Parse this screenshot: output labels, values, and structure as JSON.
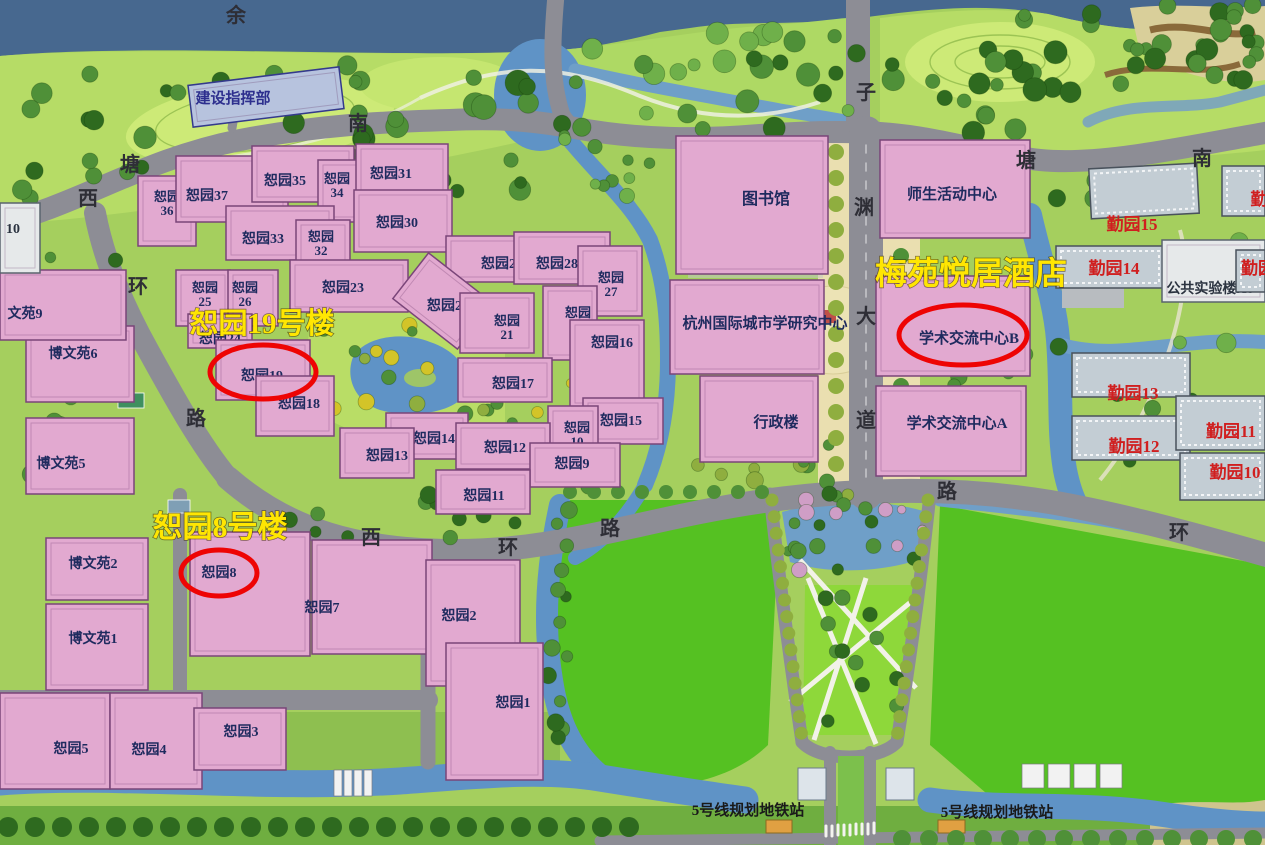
{
  "map_title": "校园总平面图",
  "colors": {
    "water_top": "#47688f",
    "water": "#5f93c6",
    "field_green": "#55c122",
    "ground": "#a5cf5e",
    "meadow": "#b6dc66",
    "road": "#8d8d95",
    "building_pink": "#e2a9d0",
    "building_gray": "#c3cdd4",
    "label_navy": "#1e2a5e",
    "label_red": "#d01f1f",
    "annotation_yellow": "#ffe602",
    "highlight_red": "#ee0404",
    "plaza_tan": "#eadfb0",
    "metro_orange": "#e0a042"
  },
  "annotations": [
    {
      "text": "恕园19号楼",
      "x": 262,
      "y": 333,
      "size": 29
    },
    {
      "text": "恕园8号楼",
      "x": 220,
      "y": 537,
      "size": 30
    },
    {
      "text": "梅苑悦居酒店",
      "x": 971,
      "y": 284,
      "size": 32
    }
  ],
  "highlights": [
    {
      "cx": 263,
      "cy": 372,
      "rx": 53,
      "ry": 27
    },
    {
      "cx": 219,
      "cy": 573,
      "rx": 38,
      "ry": 23
    },
    {
      "cx": 963,
      "cy": 335,
      "rx": 64,
      "ry": 30
    }
  ],
  "buildings": [
    {
      "label": "恕园36",
      "two": true,
      "kind": "p",
      "x": 138,
      "y": 176,
      "w": 58,
      "h": 70,
      "lx": 167,
      "ly": 201
    },
    {
      "label": "恕园37",
      "kind": "p",
      "x": 176,
      "y": 156,
      "w": 112,
      "h": 66,
      "lx": 207,
      "ly": 200
    },
    {
      "label": "恕园35",
      "kind": "p",
      "x": 252,
      "y": 146,
      "w": 102,
      "h": 56,
      "lx": 285,
      "ly": 185
    },
    {
      "label": "恕园34",
      "two": true,
      "kind": "p",
      "x": 318,
      "y": 160,
      "w": 54,
      "h": 62,
      "lx": 337,
      "ly": 183
    },
    {
      "label": "恕园31",
      "kind": "p",
      "x": 356,
      "y": 144,
      "w": 92,
      "h": 52,
      "lx": 391,
      "ly": 178
    },
    {
      "label": "恕园33",
      "kind": "p",
      "x": 226,
      "y": 206,
      "w": 108,
      "h": 54,
      "lx": 263,
      "ly": 243
    },
    {
      "label": "恕园32",
      "two": true,
      "kind": "p",
      "x": 296,
      "y": 220,
      "w": 54,
      "h": 58,
      "lx": 321,
      "ly": 241
    },
    {
      "label": "恕园30",
      "kind": "p",
      "x": 354,
      "y": 190,
      "w": 98,
      "h": 62,
      "lx": 397,
      "ly": 227
    },
    {
      "label": "恕园29",
      "kind": "p",
      "x": 446,
      "y": 236,
      "w": 92,
      "h": 46,
      "lx": 502,
      "ly": 268
    },
    {
      "label": "恕园28",
      "kind": "p",
      "x": 514,
      "y": 232,
      "w": 96,
      "h": 52,
      "lx": 557,
      "ly": 268
    },
    {
      "label": "恕园27",
      "two": true,
      "kind": "p",
      "x": 578,
      "y": 246,
      "w": 64,
      "h": 70,
      "lx": 611,
      "ly": 282
    },
    {
      "label": "恕园25",
      "two": true,
      "kind": "p",
      "x": 176,
      "y": 270,
      "w": 54,
      "h": 56,
      "lx": 205,
      "ly": 292
    },
    {
      "label": "恕园26",
      "two": true,
      "kind": "p",
      "x": 228,
      "y": 270,
      "w": 50,
      "h": 56,
      "lx": 245,
      "ly": 292
    },
    {
      "label": "恕园24",
      "kind": "p",
      "x": 188,
      "y": 314,
      "w": 64,
      "h": 34,
      "lx": 220,
      "ly": 343
    },
    {
      "label": "恕园23",
      "kind": "p",
      "x": 290,
      "y": 260,
      "w": 118,
      "h": 52,
      "lx": 343,
      "ly": 292
    },
    {
      "label": "恕园22",
      "kind": "p",
      "x": 402,
      "y": 272,
      "w": 82,
      "h": 58,
      "rot": 38,
      "lx": 448,
      "ly": 310
    },
    {
      "label": "恕园21",
      "two": true,
      "kind": "p",
      "x": 460,
      "y": 293,
      "w": 74,
      "h": 60,
      "lx": 507,
      "ly": 325
    },
    {
      "label": "恕园20",
      "two": true,
      "kind": "p",
      "x": 543,
      "y": 286,
      "w": 54,
      "h": 74,
      "lx": 578,
      "ly": 317
    },
    {
      "label": "恕园16",
      "kind": "p",
      "x": 570,
      "y": 320,
      "w": 74,
      "h": 88,
      "lx": 612,
      "ly": 347
    },
    {
      "label": "恕园19",
      "kind": "p",
      "x": 216,
      "y": 340,
      "w": 94,
      "h": 60,
      "lx": 262,
      "ly": 380
    },
    {
      "label": "恕园18",
      "kind": "p",
      "x": 256,
      "y": 376,
      "w": 78,
      "h": 60,
      "lx": 299,
      "ly": 408
    },
    {
      "label": "恕园17",
      "kind": "p",
      "x": 458,
      "y": 358,
      "w": 94,
      "h": 44,
      "lx": 513,
      "ly": 388
    },
    {
      "label": "恕园14",
      "kind": "p",
      "x": 386,
      "y": 413,
      "w": 82,
      "h": 46,
      "lx": 434,
      "ly": 443
    },
    {
      "label": "恕园13",
      "kind": "p",
      "x": 340,
      "y": 428,
      "w": 74,
      "h": 50,
      "lx": 387,
      "ly": 460
    },
    {
      "label": "恕园15",
      "kind": "p",
      "x": 583,
      "y": 398,
      "w": 80,
      "h": 46,
      "lx": 621,
      "ly": 425
    },
    {
      "label": "恕园10",
      "two": true,
      "kind": "p",
      "x": 548,
      "y": 406,
      "w": 50,
      "h": 64,
      "lx": 577,
      "ly": 432
    },
    {
      "label": "恕园12",
      "kind": "p",
      "x": 456,
      "y": 423,
      "w": 94,
      "h": 46,
      "lx": 505,
      "ly": 452
    },
    {
      "label": "恕园9",
      "kind": "p",
      "x": 530,
      "y": 443,
      "w": 90,
      "h": 44,
      "lx": 572,
      "ly": 468
    },
    {
      "label": "恕园11",
      "kind": "p",
      "x": 436,
      "y": 470,
      "w": 94,
      "h": 44,
      "lx": 484,
      "ly": 500
    },
    {
      "label": "图书馆",
      "kind": "p",
      "x": 676,
      "y": 136,
      "w": 152,
      "h": 138,
      "lx": 766,
      "ly": 204,
      "fs": 16
    },
    {
      "label": "师生活动中心",
      "kind": "p",
      "x": 880,
      "y": 140,
      "w": 150,
      "h": 98,
      "lx": 952,
      "ly": 199,
      "fs": 15
    },
    {
      "label": "杭州国际城市学研究中心",
      "kind": "p",
      "x": 670,
      "y": 280,
      "w": 154,
      "h": 94,
      "lx": 765,
      "ly": 328,
      "fs": 15
    },
    {
      "label": "行政楼",
      "kind": "p",
      "x": 700,
      "y": 376,
      "w": 118,
      "h": 86,
      "lx": 776,
      "ly": 427,
      "fs": 15
    },
    {
      "label": "学术交流中心B",
      "kind": "p",
      "x": 876,
      "y": 276,
      "w": 154,
      "h": 100,
      "lx": 969,
      "ly": 343,
      "fs": 15
    },
    {
      "label": "学术交流中心A",
      "kind": "p",
      "x": 876,
      "y": 386,
      "w": 150,
      "h": 90,
      "lx": 957,
      "ly": 428,
      "fs": 15
    },
    {
      "label": "恕园8",
      "kind": "p",
      "x": 190,
      "y": 532,
      "w": 120,
      "h": 124,
      "lx": 219,
      "ly": 577
    },
    {
      "label": "恕园7",
      "kind": "p",
      "x": 312,
      "y": 540,
      "w": 120,
      "h": 114,
      "lx": 322,
      "ly": 612
    },
    {
      "label": "博文苑2",
      "kind": "p",
      "x": 46,
      "y": 538,
      "w": 102,
      "h": 62,
      "lx": 93,
      "ly": 568
    },
    {
      "label": "博文苑1",
      "kind": "p",
      "x": 46,
      "y": 604,
      "w": 102,
      "h": 86,
      "lx": 93,
      "ly": 643
    },
    {
      "label": "博文苑6",
      "kind": "p",
      "x": 26,
      "y": 326,
      "w": 108,
      "h": 76,
      "lx": 73,
      "ly": 358
    },
    {
      "label": "博文苑5",
      "kind": "p",
      "x": 26,
      "y": 418,
      "w": 108,
      "h": 76,
      "lx": 61,
      "ly": 468
    },
    {
      "label": "文苑9",
      "kind": "p",
      "x": 0,
      "y": 270,
      "w": 126,
      "h": 70,
      "lx": 25,
      "ly": 318
    },
    {
      "label": "10",
      "kind": "w",
      "x": 0,
      "y": 203,
      "w": 40,
      "h": 70,
      "lx": 13,
      "ly": 233
    },
    {
      "label": "恕园5",
      "kind": "p",
      "x": 0,
      "y": 693,
      "w": 110,
      "h": 96,
      "lx": 71,
      "ly": 753
    },
    {
      "label": "恕园4",
      "kind": "p",
      "x": 110,
      "y": 693,
      "w": 92,
      "h": 96,
      "lx": 149,
      "ly": 754
    },
    {
      "label": "恕园3",
      "kind": "p",
      "x": 194,
      "y": 708,
      "w": 92,
      "h": 62,
      "lx": 241,
      "ly": 736
    },
    {
      "label": "恕园2",
      "kind": "p",
      "x": 426,
      "y": 560,
      "w": 94,
      "h": 126,
      "lx": 459,
      "ly": 620
    },
    {
      "label": "恕园1",
      "kind": "p",
      "x": 446,
      "y": 643,
      "w": 97,
      "h": 137,
      "lx": 513,
      "ly": 707
    },
    {
      "label": "勤园15",
      "kind": "g",
      "x": 1090,
      "y": 166,
      "w": 108,
      "h": 50,
      "rot": -3,
      "lx": 1132,
      "ly": 230,
      "fs": 17
    },
    {
      "label": "勤园14",
      "kind": "g",
      "x": 1056,
      "y": 246,
      "w": 108,
      "h": 42,
      "lx": 1114,
      "ly": 274,
      "fs": 17
    },
    {
      "label": "公共实验楼A6",
      "kind": "w",
      "x": 1162,
      "y": 240,
      "w": 103,
      "h": 62,
      "lx": 1210,
      "ly": 293,
      "fs": 14
    },
    {
      "label": "勤园13",
      "kind": "g",
      "x": 1072,
      "y": 353,
      "w": 118,
      "h": 44,
      "lx": 1133,
      "ly": 399,
      "fs": 17
    },
    {
      "label": "勤园12",
      "kind": "g",
      "x": 1072,
      "y": 416,
      "w": 118,
      "h": 44,
      "lx": 1134,
      "ly": 452,
      "fs": 17
    },
    {
      "label": "勤园11",
      "kind": "g",
      "x": 1176,
      "y": 396,
      "w": 89,
      "h": 54,
      "lx": 1231,
      "ly": 437,
      "fs": 17
    },
    {
      "label": "勤园10",
      "kind": "g",
      "x": 1180,
      "y": 453,
      "w": 85,
      "h": 47,
      "lx": 1235,
      "ly": 478,
      "fs": 17
    },
    {
      "label": "勤",
      "kind": "g",
      "x": 1222,
      "y": 166,
      "w": 43,
      "h": 50,
      "lx": 1259,
      "ly": 205,
      "fs": 17
    },
    {
      "label": "勤园",
      "kind": "g",
      "x": 1236,
      "y": 250,
      "w": 29,
      "h": 42,
      "lx": 1258,
      "ly": 274,
      "fs": 17
    },
    {
      "label": "建设指挥部",
      "kind": "b",
      "x": 190,
      "y": 76,
      "w": 152,
      "h": 42,
      "rot": -7,
      "lx": 233,
      "ly": 103,
      "fs": 15
    }
  ],
  "road_labels": [
    {
      "text": "余",
      "x": 236,
      "y": 22
    },
    {
      "text": "南",
      "x": 358,
      "y": 130
    },
    {
      "text": "塘",
      "x": 130,
      "y": 171
    },
    {
      "text": "西",
      "x": 88,
      "y": 205
    },
    {
      "text": "环",
      "x": 138,
      "y": 293
    },
    {
      "text": "路",
      "x": 196,
      "y": 425
    },
    {
      "text": "西",
      "x": 371,
      "y": 544
    },
    {
      "text": "环",
      "x": 508,
      "y": 554
    },
    {
      "text": "路",
      "x": 610,
      "y": 535
    },
    {
      "text": "子",
      "x": 866,
      "y": 99
    },
    {
      "text": "塘",
      "x": 1026,
      "y": 167
    },
    {
      "text": "南",
      "x": 1202,
      "y": 165
    },
    {
      "text": "渊",
      "x": 864,
      "y": 214
    },
    {
      "text": "大",
      "x": 866,
      "y": 323
    },
    {
      "text": "道",
      "x": 866,
      "y": 427
    },
    {
      "text": "路",
      "x": 947,
      "y": 498
    },
    {
      "text": "环",
      "x": 1179,
      "y": 539
    }
  ],
  "stations": [
    {
      "text": "5号线规划地铁站",
      "x": 748,
      "y": 815
    },
    {
      "text": "5号线规划地铁站",
      "x": 997,
      "y": 817
    }
  ]
}
